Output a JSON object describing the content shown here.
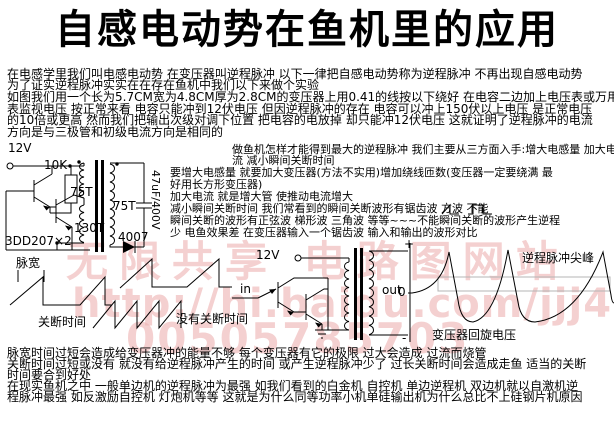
{
  "title": "自感电动势在鱼机里的应用",
  "intro": [
    "在电感学里我们叫电感电动势 在变压器叫逆程脉冲 以下一律把自感电动势称为逆程脉冲 不再出现自感电动势",
    "为了证实逆程脉冲实实在在存在鱼机中我们以下来做个实验",
    "如图我们用一个长为5.7CM宽为4.8CM厚为2.8CM的变压器上用0.41的线按以下绕好 在电容二边加上电压表或万用",
    "表监视电压 按正常来看 电容只能冲到12伏电压 但因逆程脉冲的存在 电容可以冲上150伏以上电压 是正常电压",
    "的10倍或更高 然而我们把输出次级对调下位置 把电容的电放掉 却只能冲12伏电压 这就证明了逆程脉冲的电流",
    "方向是与三极管和初级电流方向是相同的"
  ],
  "right_col": {
    "l1": "做鱼机怎样才能得到最大的逆程脉冲 我们主要从三方面入手:增大电感量 加大电",
    "l2": "流 减小瞬间关断时间",
    "l3": "要增大电感量 就要加大变压器(方法不实用)增加绕线匝数(变压器一定要绕满 最",
    "l4": "好用长方形变压器)",
    "l5": "加大电流 就是增大管 使推动电流增大",
    "l6a": "减小瞬间关断时间 我们常看到的瞬间关断波形有锯齿波",
    "l6b": "方波",
    "l6c": "不能",
    "l7": "瞬间关断的波形有正弦波 梯形波 三角波 等等~~~不能瞬间关断的波形产生逆程",
    "l8": "少 电鱼效果差 在变压器输入一个锯齿波 输入和输出的波形对比"
  },
  "circuit1": {
    "supply": "12V",
    "resistor": "10K",
    "primary_top": "75T",
    "primary_bottom": "130T",
    "transistors": "3DD207×2",
    "secondary": "75T",
    "capacitor": "47uF/400V",
    "diode": "4007"
  },
  "waveform_labels": {
    "pulse_width": "脉宽",
    "off_time": "关断时间",
    "no_off_time": "没有关断时间"
  },
  "circuit2": {
    "supply": "12V",
    "input": "in",
    "output": "out",
    "plus": "+",
    "zero": "0",
    "minus": "-",
    "spike_label": "逆程脉冲尖峰",
    "swing_label": "变压器回旋电压"
  },
  "bottom": [
    "脉宽时间过短会造成给变压器冲的能量不够 每个变压器有它的极限 过大会造成 过流而烧管",
    "关断时间过短或没有 就没有给逆程脉冲产生的时间 或产生逆程脉冲少了 过长关断时间会造成走鱼 适当的关断",
    "时间要合到好处",
    "在现实鱼机之中 一般单边机的逆程脉冲为最强 如我们看到的白金机 自控机 单边逆程机 双边机就以自激机逆",
    "程脉冲最强 如反激励自控机 灯炮机等等 这就是为什么同等功率小机单硅输出机为什么总比不上硅钢片机原因"
  ],
  "watermark": {
    "line1": "无限共享 电路图网站",
    "line2": "http://hi.baidu.com/jjj4",
    "line3": "00505785703",
    "color": "#eeb4b4"
  },
  "icons": {
    "sawtooth_wave_icon": "/|_",
    "square_wave_icon": "_|¯|_"
  },
  "colors": {
    "text": "#000000",
    "watermark": "#eeb4b4",
    "reference_box": "#b4b4b4",
    "background": "#ffffff"
  }
}
